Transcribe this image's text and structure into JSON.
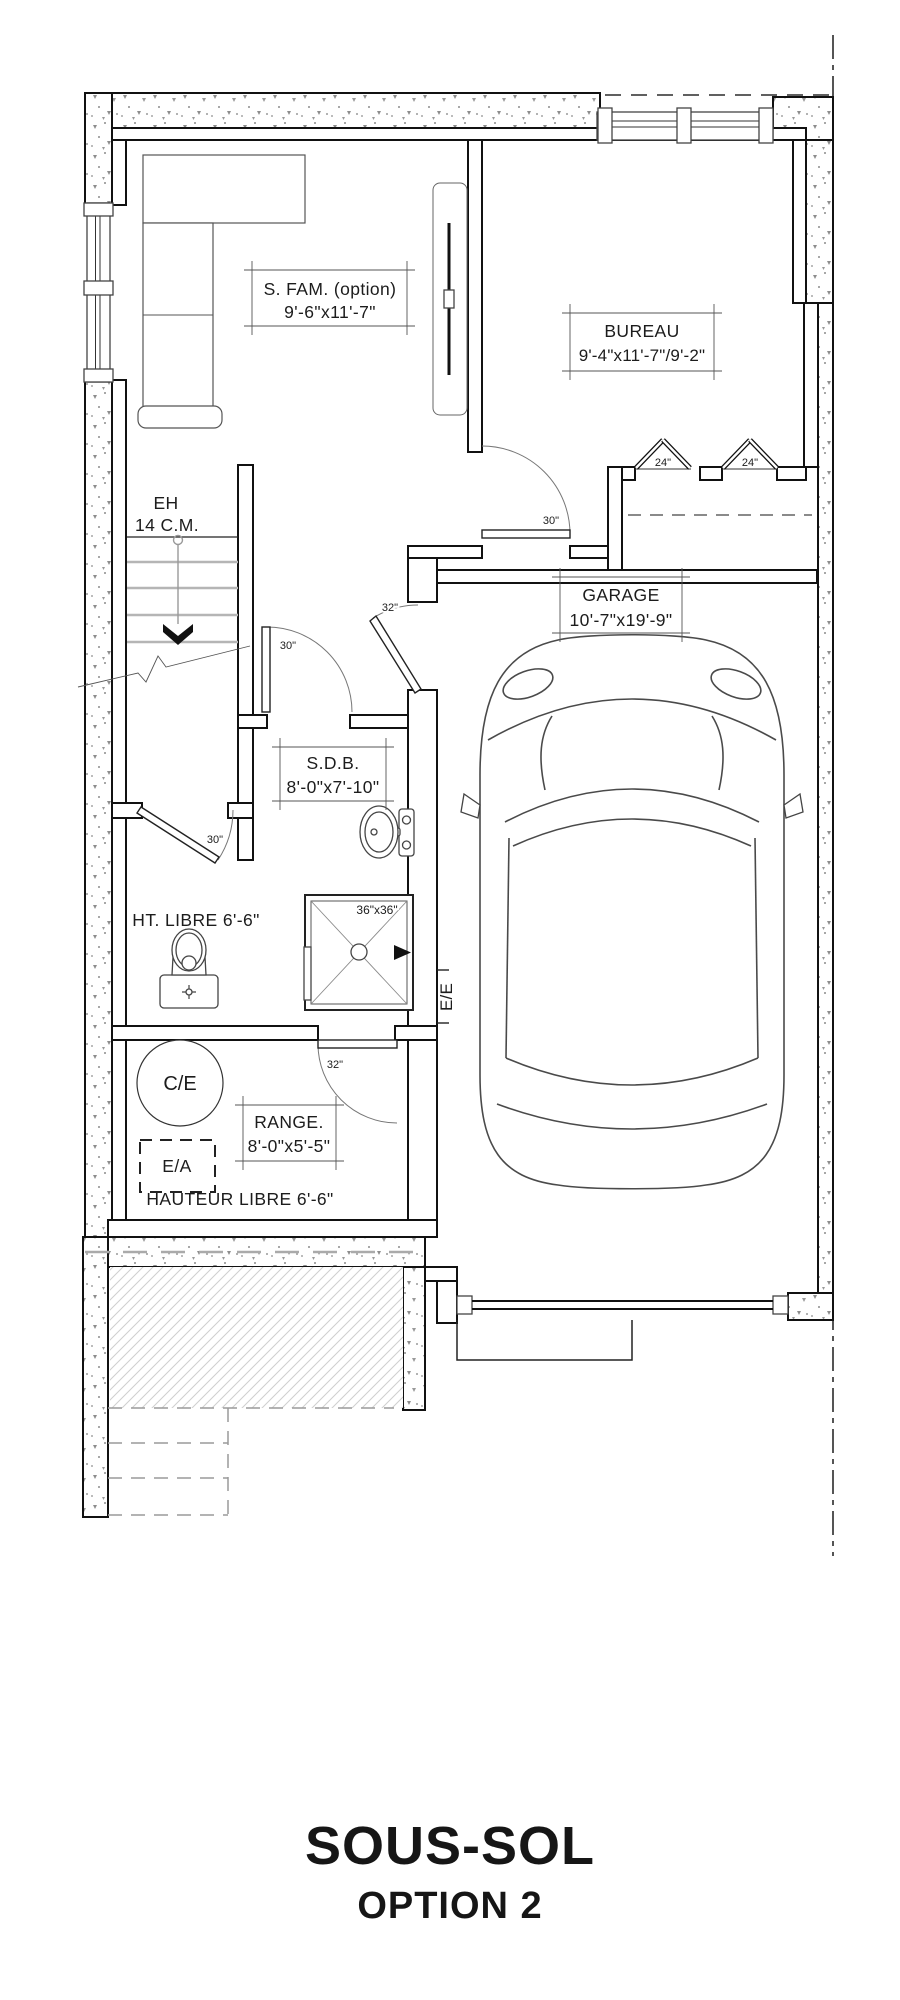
{
  "title": {
    "main": "SOUS-SOL",
    "sub": "OPTION 2"
  },
  "rooms": {
    "s_fam": {
      "name": "S. FAM. (option)",
      "dims": "9'-6\"x11'-7\""
    },
    "bureau": {
      "name": "BUREAU",
      "dims": "9'-4\"x11'-7\"/9'-2\""
    },
    "garage": {
      "name": "GARAGE",
      "dims": "10'-7\"x19'-9\""
    },
    "sdb": {
      "name": "S.D.B.",
      "dims": "8'-0\"x7'-10\""
    },
    "range": {
      "name": "RANGE.",
      "dims": "8'-0\"x5'-5\""
    }
  },
  "annotations": {
    "stair": "EH",
    "stair_risers": "14 C.M.",
    "toilet_height": "HT. LIBRE 6'-6\"",
    "storage_height": "HAUTEUR LIBRE 6'-6\"",
    "shower": "36\"x36\"",
    "water_heater": "C/E",
    "air_exchanger": "E/A",
    "electrical": "E/E"
  },
  "doors": {
    "family_door": "30\"",
    "bathroom_door": "30\"",
    "toilet_door": "30\"",
    "garage_entry_door": "32\"",
    "storage_door": "32\"",
    "closet_door_left": "24\"",
    "closet_door_right": "24\""
  },
  "colors": {
    "line": "#1a1a1a",
    "concrete_speck": "#8d8d8d",
    "hatch": "#cfcfcf"
  }
}
